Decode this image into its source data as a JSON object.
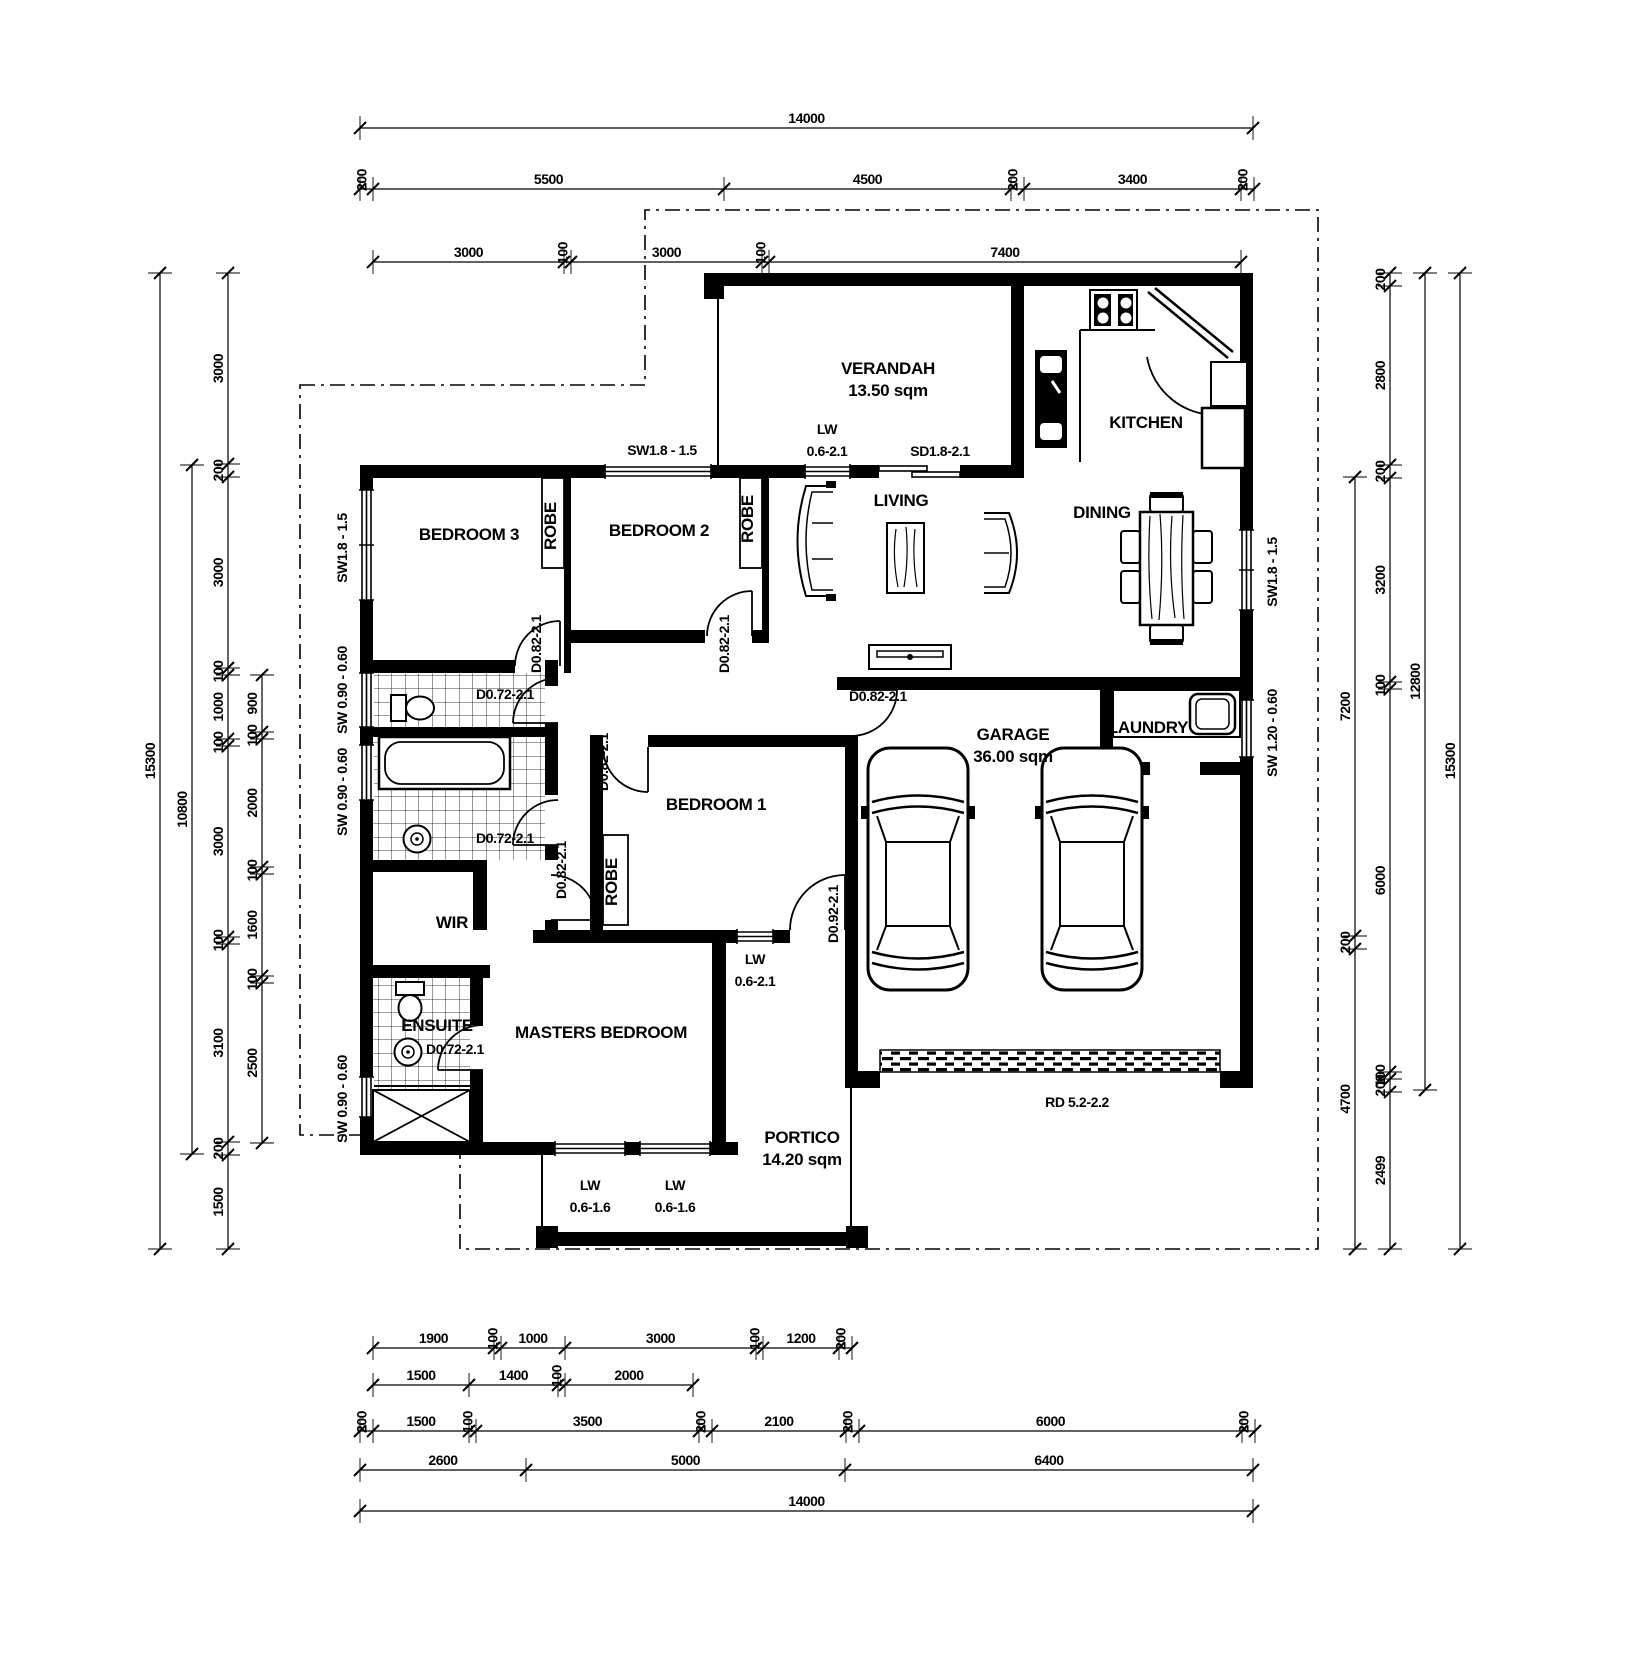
{
  "drawing": {
    "type": "residential floor plan",
    "ink_color": "#000000",
    "paper_color": "#ffffff"
  },
  "labels": [
    {
      "t": "VERANDAH",
      "x": 888,
      "y": 374,
      "k": "room",
      "name": "room-label-verandah"
    },
    {
      "t": "13.50 sqm",
      "x": 888,
      "y": 396,
      "k": "room",
      "name": "room-area-verandah"
    },
    {
      "t": "KITCHEN",
      "x": 1146,
      "y": 428,
      "k": "room",
      "name": "room-label-kitchen"
    },
    {
      "t": "LIVING",
      "x": 901,
      "y": 506,
      "k": "room",
      "name": "room-label-living"
    },
    {
      "t": "DINING",
      "x": 1102,
      "y": 518,
      "k": "room",
      "name": "room-label-dining"
    },
    {
      "t": "BEDROOM 3",
      "x": 469,
      "y": 540,
      "k": "room",
      "name": "room-label-bedroom3"
    },
    {
      "t": "BEDROOM 2",
      "x": 659,
      "y": 536,
      "k": "room",
      "name": "room-label-bedroom2"
    },
    {
      "t": "BEDROOM 1",
      "x": 716,
      "y": 810,
      "k": "room",
      "name": "room-label-bedroom1"
    },
    {
      "t": "MASTERS BEDROOM",
      "x": 601,
      "y": 1038,
      "k": "room",
      "name": "room-label-masters-bedroom"
    },
    {
      "t": "GARAGE",
      "x": 1013,
      "y": 740,
      "k": "room",
      "name": "room-label-garage"
    },
    {
      "t": "36.00 sqm",
      "x": 1013,
      "y": 762,
      "k": "room",
      "name": "room-area-garage"
    },
    {
      "t": "LAUNDRY",
      "x": 1148,
      "y": 733,
      "k": "room",
      "name": "room-label-laundry"
    },
    {
      "t": "ENSUITE",
      "x": 437,
      "y": 1031,
      "k": "room",
      "name": "room-label-ensuite"
    },
    {
      "t": "WIR",
      "x": 452,
      "y": 928,
      "k": "room",
      "name": "room-label-wir"
    },
    {
      "t": "PORTICO",
      "x": 802,
      "y": 1143,
      "k": "room",
      "name": "room-label-portico"
    },
    {
      "t": "14.20 sqm",
      "x": 802,
      "y": 1165,
      "k": "room",
      "name": "room-area-portico"
    },
    {
      "t": "ROBE",
      "x": 556,
      "y": 526,
      "k": "room",
      "r": -90,
      "name": "robe-label-bedroom3"
    },
    {
      "t": "ROBE",
      "x": 753,
      "y": 519,
      "k": "room",
      "r": -90,
      "name": "robe-label-bedroom2"
    },
    {
      "t": "ROBE",
      "x": 617,
      "y": 882,
      "k": "room",
      "r": -90,
      "name": "robe-label-bedroom1"
    },
    {
      "t": "SW1.8 - 1.5",
      "x": 662,
      "y": 455,
      "k": "open",
      "name": "window-label-bedroom2-north"
    },
    {
      "t": "SW1.8 - 1.5",
      "x": 347,
      "y": 548,
      "k": "open",
      "r": -90,
      "name": "window-label-bedroom3-west"
    },
    {
      "t": "SW1.8 - 1.5",
      "x": 1277,
      "y": 572,
      "k": "open",
      "r": -90,
      "name": "window-label-dining-east"
    },
    {
      "t": "SW 1.20 - 0.60",
      "x": 1277,
      "y": 733,
      "k": "open",
      "r": -90,
      "name": "window-label-laundry-east"
    },
    {
      "t": "SW 0.90 - 0.60",
      "x": 347,
      "y": 690,
      "k": "open",
      "r": -90,
      "name": "window-label-wc-west"
    },
    {
      "t": "SW 0.90 - 0.60",
      "x": 347,
      "y": 792,
      "k": "open",
      "r": -90,
      "name": "window-label-bath-west"
    },
    {
      "t": "SW 0.90 - 0.60",
      "x": 347,
      "y": 1099,
      "k": "open",
      "r": -90,
      "name": "window-label-shower-west"
    },
    {
      "t": "LW",
      "x": 827,
      "y": 434,
      "k": "open",
      "name": "window-label-verandah-lw"
    },
    {
      "t": "0.6-2.1",
      "x": 827,
      "y": 456,
      "k": "open",
      "name": "window-size-verandah-lw"
    },
    {
      "t": "SD1.8-2.1",
      "x": 940,
      "y": 456,
      "k": "open",
      "name": "door-label-sliding"
    },
    {
      "t": "LW",
      "x": 755,
      "y": 964,
      "k": "open",
      "name": "window-label-bedroom1-lw"
    },
    {
      "t": "0.6-2.1",
      "x": 755,
      "y": 986,
      "k": "open",
      "name": "window-size-bedroom1-lw"
    },
    {
      "t": "LW",
      "x": 590,
      "y": 1190,
      "k": "open",
      "name": "window-label-masters-lw1"
    },
    {
      "t": "0.6-1.6",
      "x": 590,
      "y": 1212,
      "k": "open",
      "name": "window-size-masters-lw1"
    },
    {
      "t": "LW",
      "x": 675,
      "y": 1190,
      "k": "open",
      "name": "window-label-masters-lw2"
    },
    {
      "t": "0.6-1.6",
      "x": 675,
      "y": 1212,
      "k": "open",
      "name": "window-size-masters-lw2"
    },
    {
      "t": "RD 5.2-2.2",
      "x": 1077,
      "y": 1107,
      "k": "open",
      "name": "door-label-roller"
    },
    {
      "t": "D0.82-2.1",
      "x": 541,
      "y": 644,
      "k": "open",
      "r": -90,
      "name": "door-label-bedroom3"
    },
    {
      "t": "D0.82-2.1",
      "x": 729,
      "y": 644,
      "k": "open",
      "r": -90,
      "name": "door-label-bedroom2"
    },
    {
      "t": "D0.72-2.1",
      "x": 505,
      "y": 699,
      "k": "open",
      "name": "door-label-wc"
    },
    {
      "t": "D0.72-2.1",
      "x": 505,
      "y": 843,
      "k": "open",
      "name": "door-label-bath"
    },
    {
      "t": "D0.82-2.1",
      "x": 566,
      "y": 870,
      "k": "open",
      "r": -90,
      "name": "door-label-masters"
    },
    {
      "t": "D0.82-2.1",
      "x": 608,
      "y": 762,
      "k": "open",
      "r": -90,
      "name": "door-label-bedroom1"
    },
    {
      "t": "D0.72-2.1",
      "x": 455,
      "y": 1054,
      "k": "open",
      "name": "door-label-ensuite"
    },
    {
      "t": "D0.82-2.1",
      "x": 878,
      "y": 701,
      "k": "open",
      "name": "door-label-garage"
    },
    {
      "t": "D0.92-2.1",
      "x": 838,
      "y": 914,
      "k": "open",
      "r": -90,
      "name": "door-label-front-entry"
    }
  ],
  "dim_chains": [
    {
      "name": "top-overall",
      "axis": "h",
      "line": 128,
      "start": 360,
      "parts": [
        [
          "14000",
          893
        ]
      ]
    },
    {
      "name": "top-row2",
      "axis": "h",
      "line": 189,
      "start": 360,
      "parts": [
        [
          "200",
          13
        ],
        [
          "5500",
          351
        ],
        [
          "4500",
          287
        ],
        [
          "200",
          13
        ],
        [
          "3400",
          217
        ],
        [
          "200",
          13
        ]
      ]
    },
    {
      "name": "top-row3",
      "axis": "h",
      "line": 262,
      "start": 373,
      "parts": [
        [
          "3000",
          191
        ],
        [
          "100",
          7
        ],
        [
          "3000",
          191
        ],
        [
          "100",
          7
        ],
        [
          "7400",
          472
        ]
      ]
    },
    {
      "name": "bottom-row1",
      "axis": "h",
      "line": 1348,
      "start": 373,
      "parts": [
        [
          "1900",
          121
        ],
        [
          "100",
          7
        ],
        [
          "1000",
          64
        ],
        [
          "3000",
          191
        ],
        [
          "100",
          7
        ],
        [
          "1200",
          76
        ],
        [
          "200",
          13
        ]
      ]
    },
    {
      "name": "bottom-row2",
      "axis": "h",
      "line": 1385,
      "start": 373,
      "parts": [
        [
          "1500",
          96
        ],
        [
          "1400",
          89
        ],
        [
          "100",
          7
        ],
        [
          "2000",
          128
        ]
      ]
    },
    {
      "name": "bottom-row3",
      "axis": "h",
      "line": 1431,
      "start": 360,
      "parts": [
        [
          "200",
          13
        ],
        [
          "1500",
          96
        ],
        [
          "100",
          7
        ],
        [
          "3500",
          223
        ],
        [
          "200",
          13
        ],
        [
          "2100",
          134
        ],
        [
          "200",
          13
        ],
        [
          "6000",
          383
        ],
        [
          "200",
          13
        ]
      ]
    },
    {
      "name": "bottom-row4",
      "axis": "h",
      "line": 1470,
      "start": 360,
      "parts": [
        [
          "2600",
          166
        ],
        [
          "5000",
          319
        ],
        [
          "6400",
          408
        ]
      ]
    },
    {
      "name": "bottom-overall",
      "axis": "h",
      "line": 1511,
      "start": 360,
      "parts": [
        [
          "14000",
          893
        ]
      ]
    },
    {
      "name": "left-overall",
      "axis": "v",
      "line": 160,
      "start": 273,
      "parts": [
        [
          "15300",
          976
        ]
      ]
    },
    {
      "name": "left-house",
      "axis": "v",
      "line": 192,
      "start": 465,
      "parts": [
        [
          "10800",
          689
        ]
      ]
    },
    {
      "name": "left-rooms",
      "axis": "v",
      "line": 228,
      "start": 273,
      "parts": [
        [
          "3000",
          191
        ],
        [
          "200",
          13
        ],
        [
          "3000",
          191
        ],
        [
          "100",
          7
        ],
        [
          "1000",
          64
        ],
        [
          "100",
          7
        ],
        [
          "3000",
          191
        ],
        [
          "100",
          7
        ],
        [
          "3100",
          198
        ],
        [
          "200",
          13
        ],
        [
          "1500",
          94
        ]
      ]
    },
    {
      "name": "left-inner",
      "axis": "v",
      "line": 262,
      "start": 675,
      "parts": [
        [
          "900",
          57
        ],
        [
          "100",
          7
        ],
        [
          "2000",
          128
        ],
        [
          "100",
          7
        ],
        [
          "1600",
          102
        ],
        [
          "100",
          7
        ],
        [
          "2500",
          160
        ]
      ]
    },
    {
      "name": "right-inner",
      "axis": "v",
      "line": 1355,
      "start": 477,
      "parts": [
        [
          "7200",
          459
        ],
        [
          "200",
          13
        ],
        [
          "4700",
          300
        ]
      ]
    },
    {
      "name": "right-rooms",
      "axis": "v",
      "line": 1390,
      "start": 273,
      "parts": [
        [
          "200",
          13
        ],
        [
          "2800",
          179
        ],
        [
          "200",
          13
        ],
        [
          "3200",
          204
        ],
        [
          "100",
          7
        ],
        [
          "6000",
          383
        ],
        [
          "100",
          7
        ],
        [
          "200",
          13
        ],
        [
          "2499",
          157
        ]
      ]
    },
    {
      "name": "right-sub",
      "axis": "v",
      "line": 1425,
      "start": 273,
      "parts": [
        [
          "12800",
          817
        ]
      ]
    },
    {
      "name": "right-overall",
      "axis": "v",
      "line": 1460,
      "start": 273,
      "parts": [
        [
          "15300",
          976
        ]
      ]
    }
  ]
}
